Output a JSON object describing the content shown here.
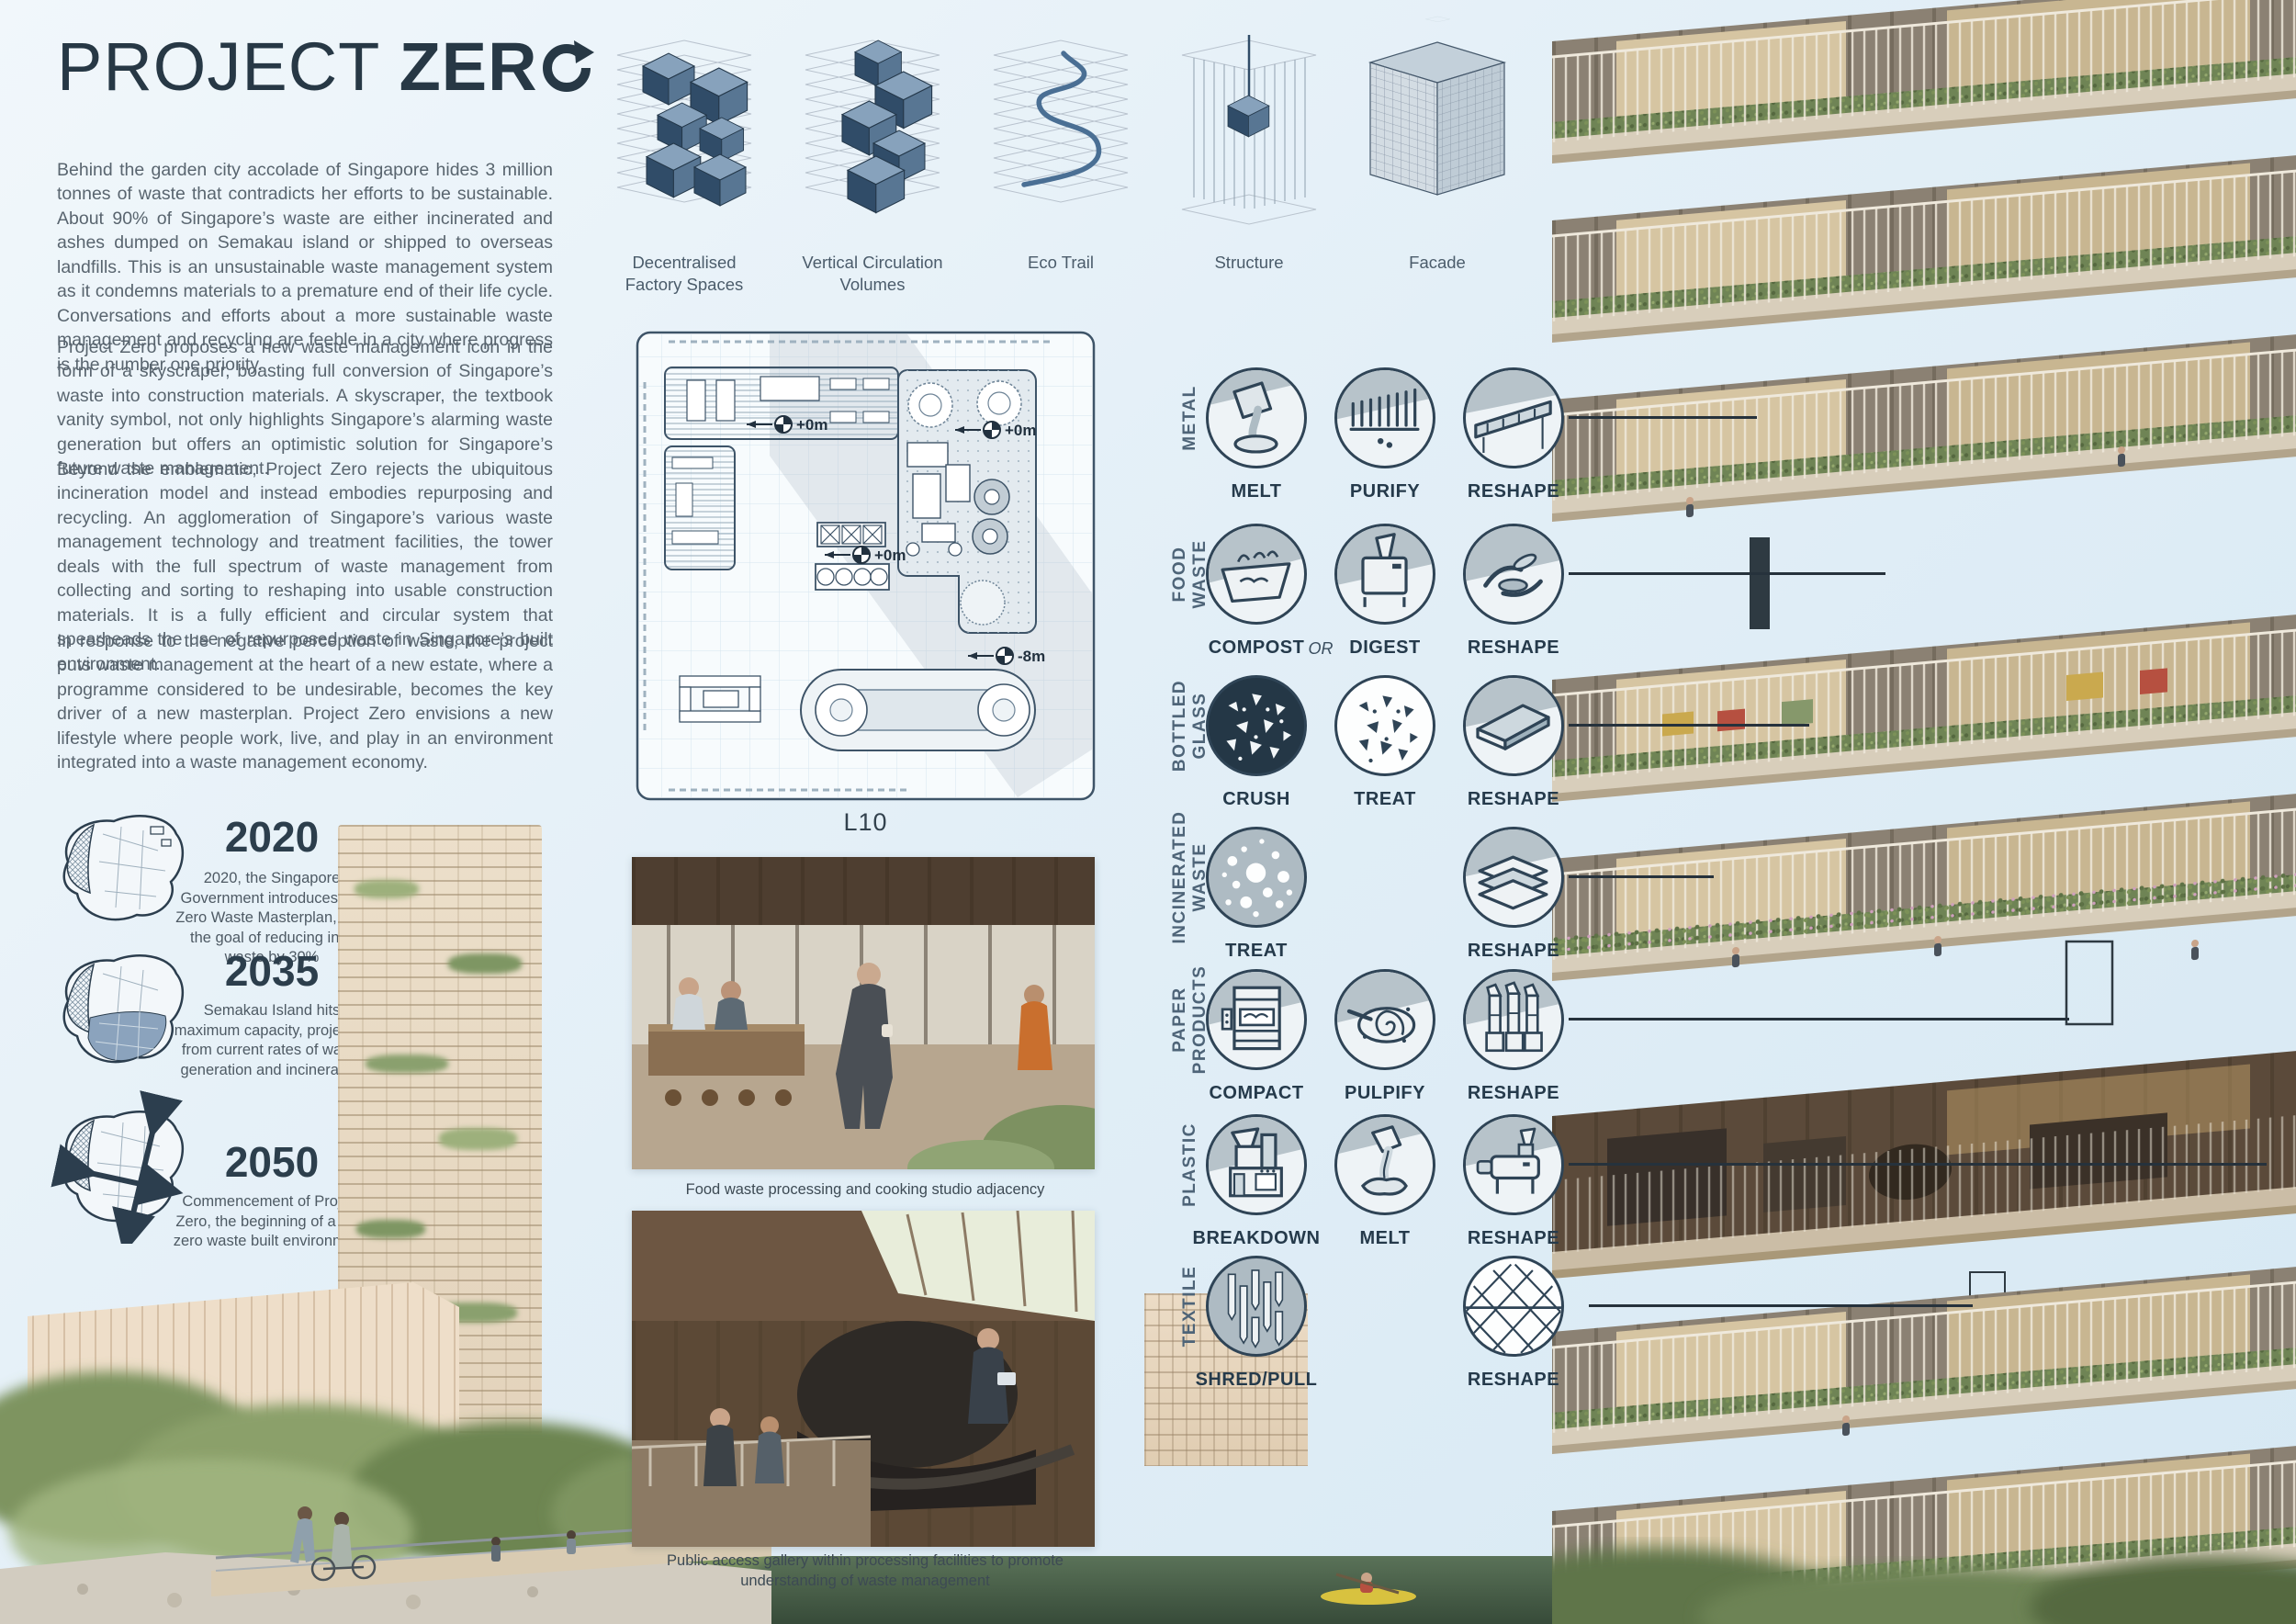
{
  "title": {
    "full": "PROJECT ZERO",
    "prefix": "PROJECT",
    "bold_part": "ZER",
    "o_icon": "recycle-arrow-o"
  },
  "intro_paragraphs": [
    "Behind the garden city accolade of Singapore hides 3 million tonnes of waste that contradicts her efforts to be sustainable. About 90% of Singapore’s waste are either incinerated and ashes dumped on Semakau island or shipped to overseas landfills. This is an unsustainable waste management system as it condemns materials to a premature end of their life cycle. Conversations and efforts about a more sustainable waste management and recycling are feeble in a city where progress is the number one priority.",
    "Project Zero proposes a new waste management icon in the form of a skyscraper, boasting full conversion of Singapore’s waste into construction materials. A skyscraper, the textbook vanity symbol, not only highlights Singapore’s alarming waste generation but offers an optimistic solution for Singapore’s future waste management.",
    "Beyond the emblematic, Project Zero rejects the ubiquitous incineration model and instead embodies repurposing and recycling. An agglomeration of Singapore’s various waste management technology and treatment facilities, the tower deals with the full spectrum of waste management from collecting and sorting to reshaping into usable construction materials. It is a fully efficient and circular system that spearheads the use of repurposed waste in Singapore’s built environment.",
    "In response to the negative perception of waste, the project puts waste management at the heart of a new estate, where a programme considered to be undesirable, becomes the key driver of a new masterplan. Project Zero envisions a new lifestyle where people work, live, and play in an environment integrated into a waste management economy."
  ],
  "concept_diagrams": [
    {
      "label": "Decentralised Factory Spaces"
    },
    {
      "label": "Vertical Circulation Volumes"
    },
    {
      "label": "Eco Trail"
    },
    {
      "label": "Structure"
    },
    {
      "label": "Facade"
    }
  ],
  "floor_plan": {
    "level_label": "L10",
    "markers": [
      {
        "text": "+0m"
      },
      {
        "text": "+0m"
      },
      {
        "text": "+0m"
      },
      {
        "text": "-8m"
      }
    ]
  },
  "timeline": [
    {
      "year": "2020",
      "text": "2020, the Singapore Government introduces the Zero Waste Masterplan, with the goal of reducing infill waste by 30%"
    },
    {
      "year": "2035",
      "text": "Semakau Island hits maximum capacity, projected from current rates of waste generation and incineration"
    },
    {
      "year": "2050",
      "text": "Commencement of Project Zero, the beginning of a new zero waste built environment."
    }
  ],
  "photos": [
    {
      "caption": "Food waste processing and cooking studio adjacency"
    },
    {
      "caption": "Public access gallery within processing facilities to promote understanding of waste management"
    }
  ],
  "matrix": {
    "rows": [
      {
        "category": "METAL",
        "steps": [
          "MELT",
          "PURIFY",
          "RESHAPE"
        ]
      },
      {
        "category": "FOOD\nWASTE",
        "steps": [
          "COMPOST",
          "DIGEST",
          "RESHAPE"
        ],
        "connector": "OR"
      },
      {
        "category": "BOTTLED\nGLASS",
        "steps": [
          "CRUSH",
          "TREAT",
          "RESHAPE"
        ]
      },
      {
        "category": "INCINERATED\nWASTE",
        "steps": [
          "TREAT",
          "RESHAPE"
        ]
      },
      {
        "category": "PAPER\nPRODUCTS",
        "steps": [
          "COMPACT",
          "PULPIFY",
          "RESHAPE"
        ]
      },
      {
        "category": "PLASTIC",
        "steps": [
          "BREAKDOWN",
          "MELT",
          "RESHAPE"
        ]
      },
      {
        "category": "TEXTILE",
        "steps": [
          "SHRED/PULL",
          "RESHAPE"
        ]
      }
    ]
  },
  "icons": {
    "title_o": "recycle-arrow-o-icon",
    "matrix": [
      "melt-pour-icon",
      "purify-filter-icon",
      "reshape-conveyor-icon",
      "compost-tray-icon",
      "digest-machine-icon",
      "reshape-hands-icon",
      "crush-shards-icon",
      "treat-shards-icon",
      "reshape-pane-icon",
      "treat-porous-icon",
      "reshape-boards-icon",
      "compact-baler-icon",
      "pulpify-vortex-icon",
      "reshape-tubes-icon",
      "breakdown-shredder-icon",
      "melt-goo-icon",
      "reshape-extruder-icon",
      "shred-strips-icon",
      "reshape-lattice-icon"
    ],
    "plan": "level-datum-marker-icon"
  },
  "colors": {
    "background": "#e3eff7",
    "ink": "#273845",
    "body_text": "#59656f",
    "diagram_blue_dark": "#304c68",
    "diagram_blue_mid": "#587693",
    "diagram_blue_light": "#87a2bc",
    "matrix_stroke": "#2f4456",
    "crush_fill": "#243746",
    "render_tan": "#d8cebb",
    "planter_green": "#6f8455",
    "water_green": "#46604a"
  }
}
